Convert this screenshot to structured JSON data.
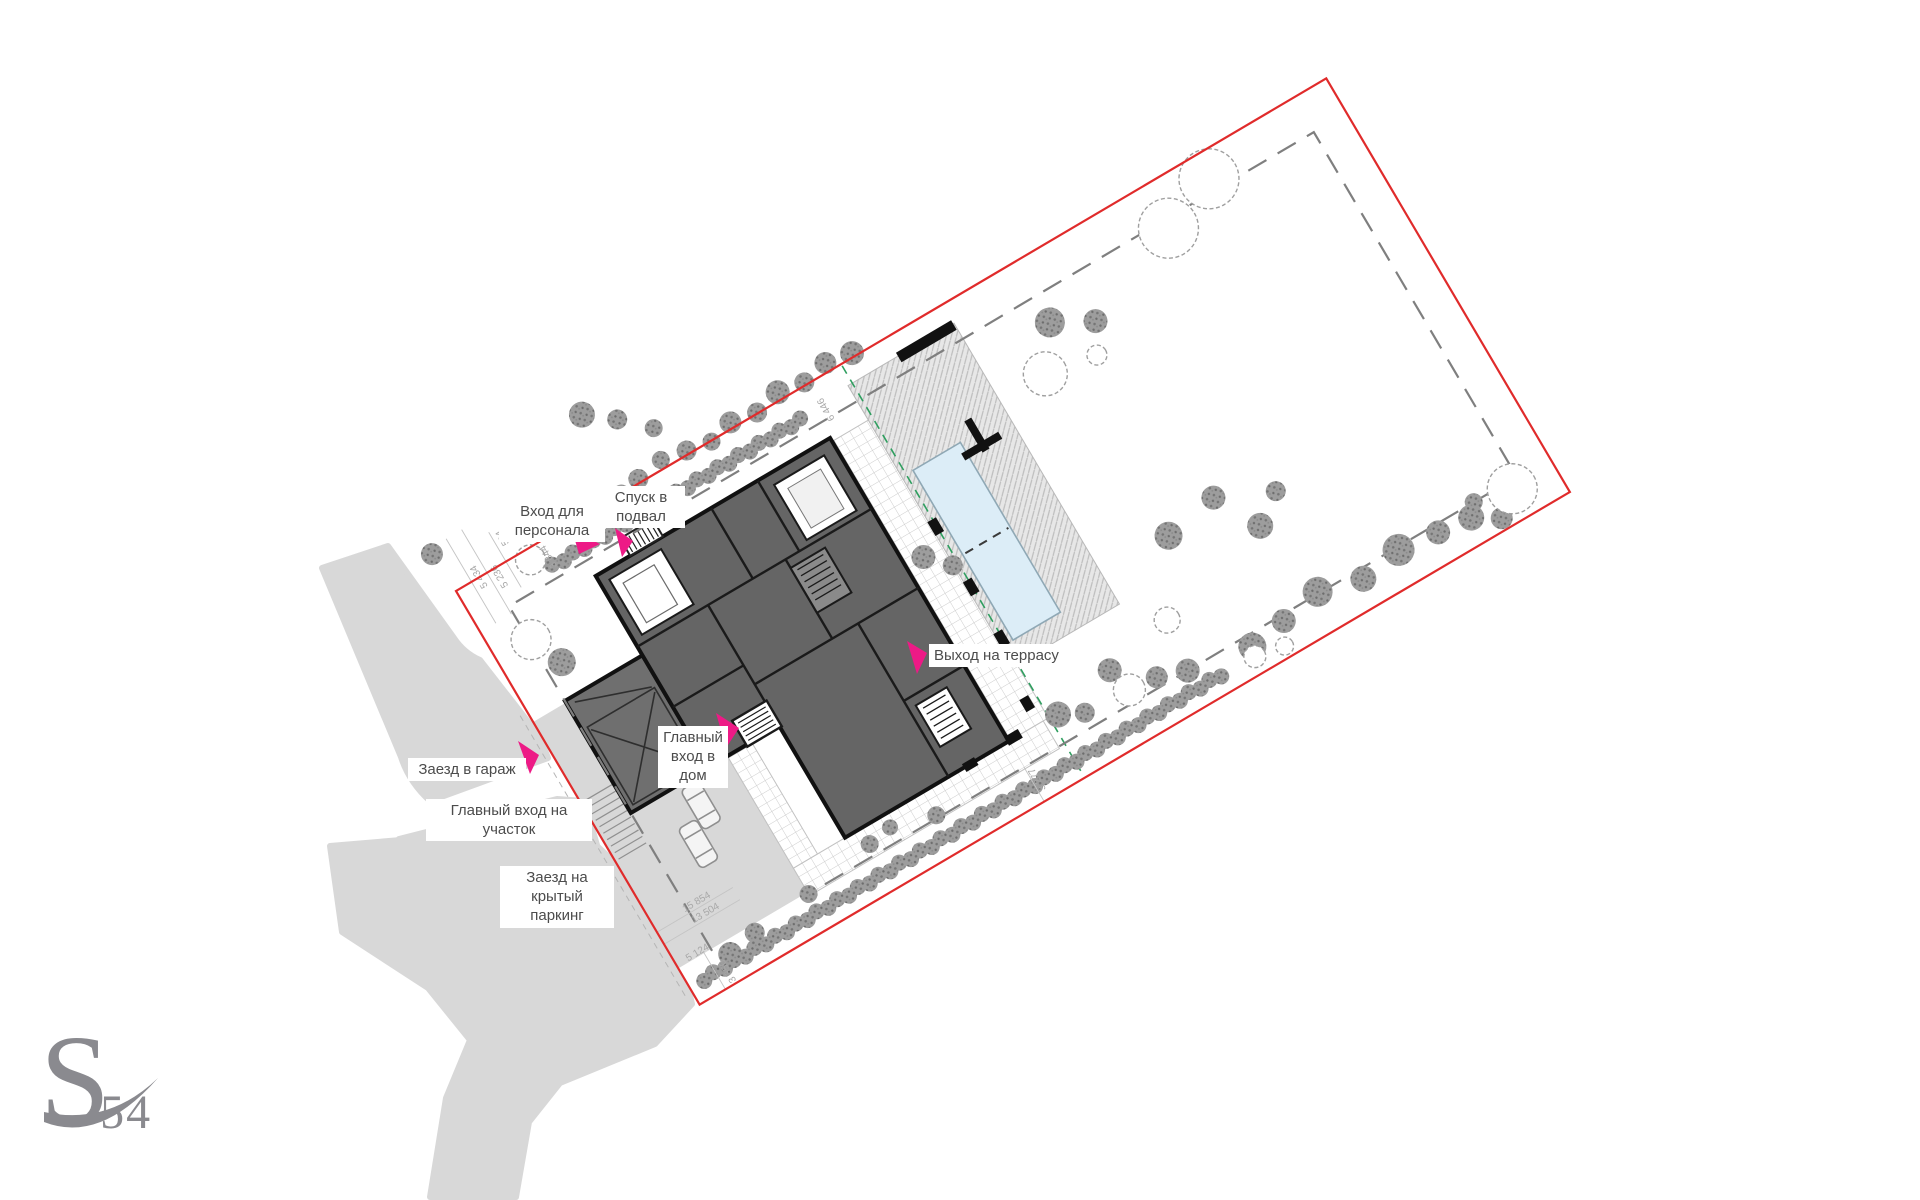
{
  "title": "Site plan — master plan of a private house plot",
  "annotations": {
    "staff_entrance": "Вход для\nперсонала",
    "basement_entrance": "Спуск в\nподвал",
    "terrace_exit": "Выход на террасу",
    "house_entrance": "Главный\nвход в\nдом",
    "garage_entry": "Заезд в гараж",
    "site_entrance": "Главный вход на\nучасток",
    "covered_parking_entry": "Заезд на\nкрытый\nпаркинг"
  },
  "dimensions": [
    "5 434",
    "5 236",
    "524",
    "3 844",
    "6 446",
    "15 854",
    "13 504",
    "5 124",
    "3 350",
    "3 277"
  ],
  "logo": {
    "letter": "S",
    "number": "54"
  },
  "colors": {
    "boundary_red": "#e02b2b",
    "accent_pink": "#ed1a86",
    "setback_gray": "#7f7f7f",
    "road_gray": "#d8d8d8",
    "building_gray": "#656565",
    "wall_black": "#111111",
    "pool_blue": "#dcedf7",
    "utility_green": "#2f9e5f",
    "logo_gray": "#8a8a8f"
  }
}
